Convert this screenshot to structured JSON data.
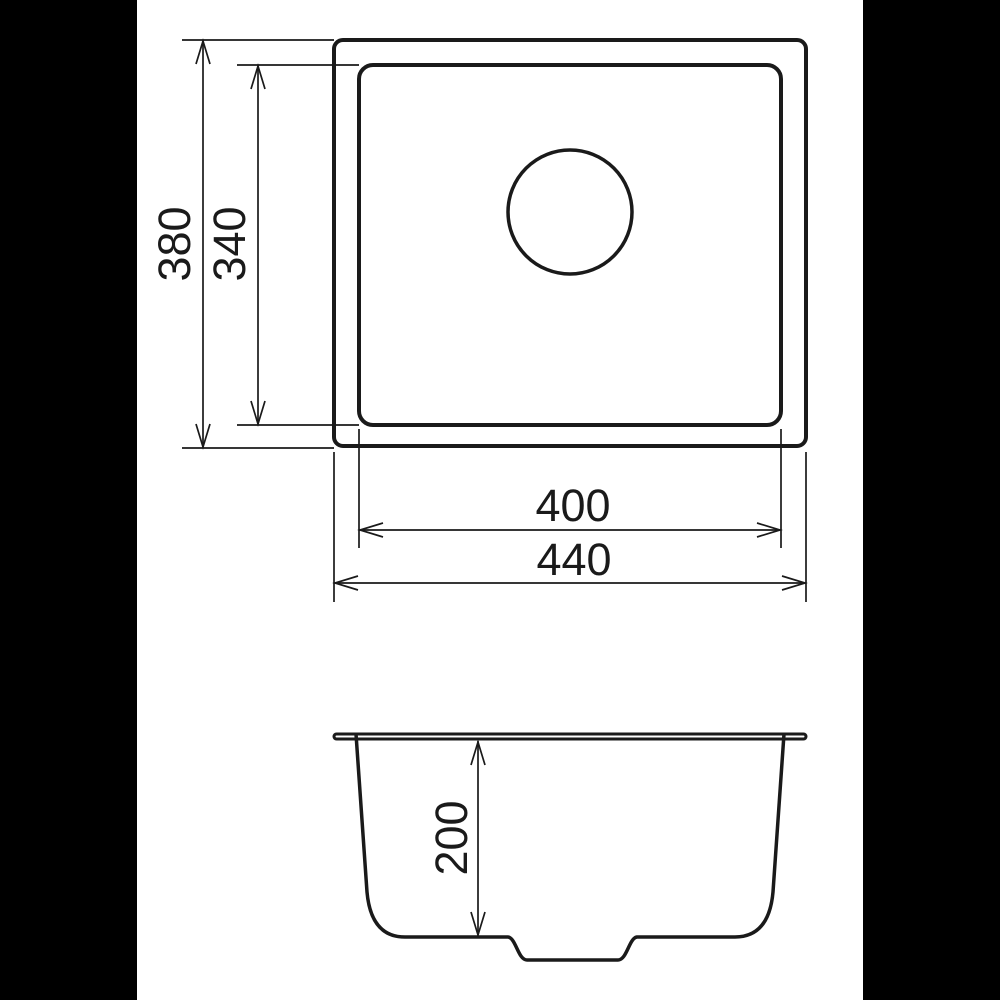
{
  "figure": {
    "kind": "sink-dimension-drawing",
    "views": {
      "top": {
        "outer_height_mm": "380",
        "inner_height_mm": "340",
        "inner_width_mm": "400",
        "outer_width_mm": "440"
      },
      "side": {
        "depth_mm": "200"
      }
    },
    "colors": {
      "line": "#1a1a1a",
      "background": "#ffffff",
      "pillarbox": "#000000"
    }
  }
}
